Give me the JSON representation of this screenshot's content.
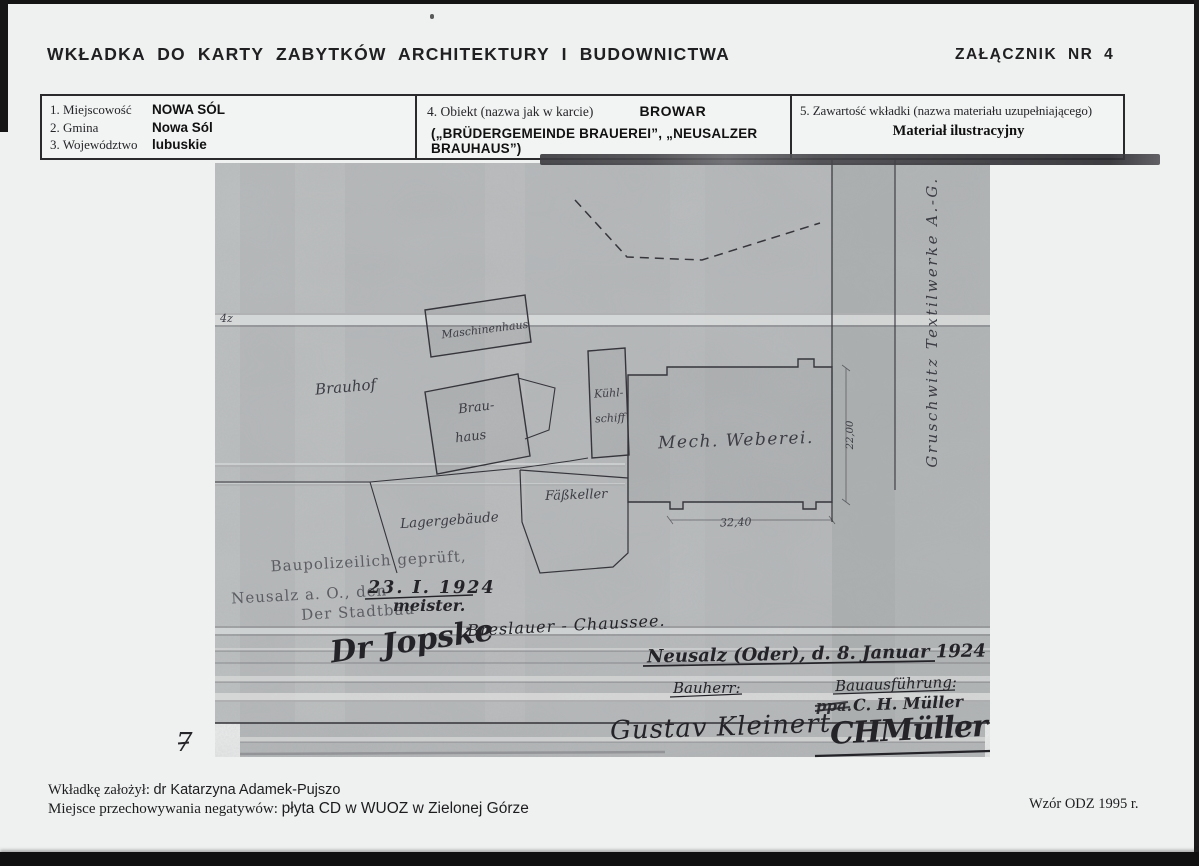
{
  "header": {
    "title": "WKŁADKA DO KARTY ZABYTKÓW ARCHITEKTURY I BUDOWNICTWA",
    "annex": "ZAŁĄCZNIK NR 4"
  },
  "info_table": {
    "location_fields": [
      {
        "label": "1. Miejscowość",
        "value": "NOWA SÓL"
      },
      {
        "label": "2. Gmina",
        "value": "Nowa Sól"
      },
      {
        "label": "3. Województwo",
        "value": "lubuskie"
      }
    ],
    "object": {
      "label": "4. Obiekt (nazwa jak w karcie)",
      "value": "BROWAR",
      "alt_names": "(„BRÜDERGEMEINDE BRAUEREI”, „NEUSALZER BRAUHAUS”)"
    },
    "contents": {
      "label": "5. Zawartość wkładki (nazwa materiału uzupełniającego)",
      "value": "Materiał ilustracyjny"
    }
  },
  "scan": {
    "plot_mark": "4z",
    "buildings": {
      "maschinenhaus": "Maschinenhaus",
      "brauhof": "Brauhof",
      "brauhaus_line1": "Brau-",
      "brauhaus_line2": "haus",
      "kuehlschiff_line1": "Kühl-",
      "kuehlschiff_line2": "schiff",
      "mech_weberei": "Mech. Weberei.",
      "faesskeller": "Fäßkeller",
      "lagergebaeude": "Lagergebäude"
    },
    "street_label": "Breslauer - Chaussee.",
    "neighbor_label": "Gruschwitz Textilwerke A.-G.",
    "dimensions": {
      "width": "32,40",
      "depth": "22,00"
    },
    "stamp": {
      "line1": "Baupolizeilich geprüft,",
      "line2": "Neusalz a. O., den",
      "date": "23. I. 1924",
      "line3": "Der Stadtbau",
      "line3_suffix": "meister.",
      "signature": "Dr Jopske"
    },
    "approval": {
      "header": "Neusalz (Oder), d. 8. Januar 1924",
      "bauherr_label": "Bauherr:",
      "bauherr_signature": "Gustav Kleinert",
      "bauausfuehrung_label": "Bauausführung:",
      "ppa_mark": "ppa.",
      "name": "C. H. Müller",
      "signature": "CHMüller"
    }
  },
  "footer": {
    "created_by_label": "Wkładkę założył:",
    "created_by": "dr Katarzyna Adamek-Pujszo",
    "negatives_label": "Miejsce przechowywania negatywów:",
    "negatives_value": "płyta CD w WUOZ w Zielonej Górze",
    "form_note": "Wzór ODZ 1995 r.",
    "page_number": "7"
  },
  "colors": {
    "paper": "#eff1f0",
    "scan_gray": "#b7babb",
    "ink": "#232328",
    "stamp_ink": "#5c5d63"
  }
}
